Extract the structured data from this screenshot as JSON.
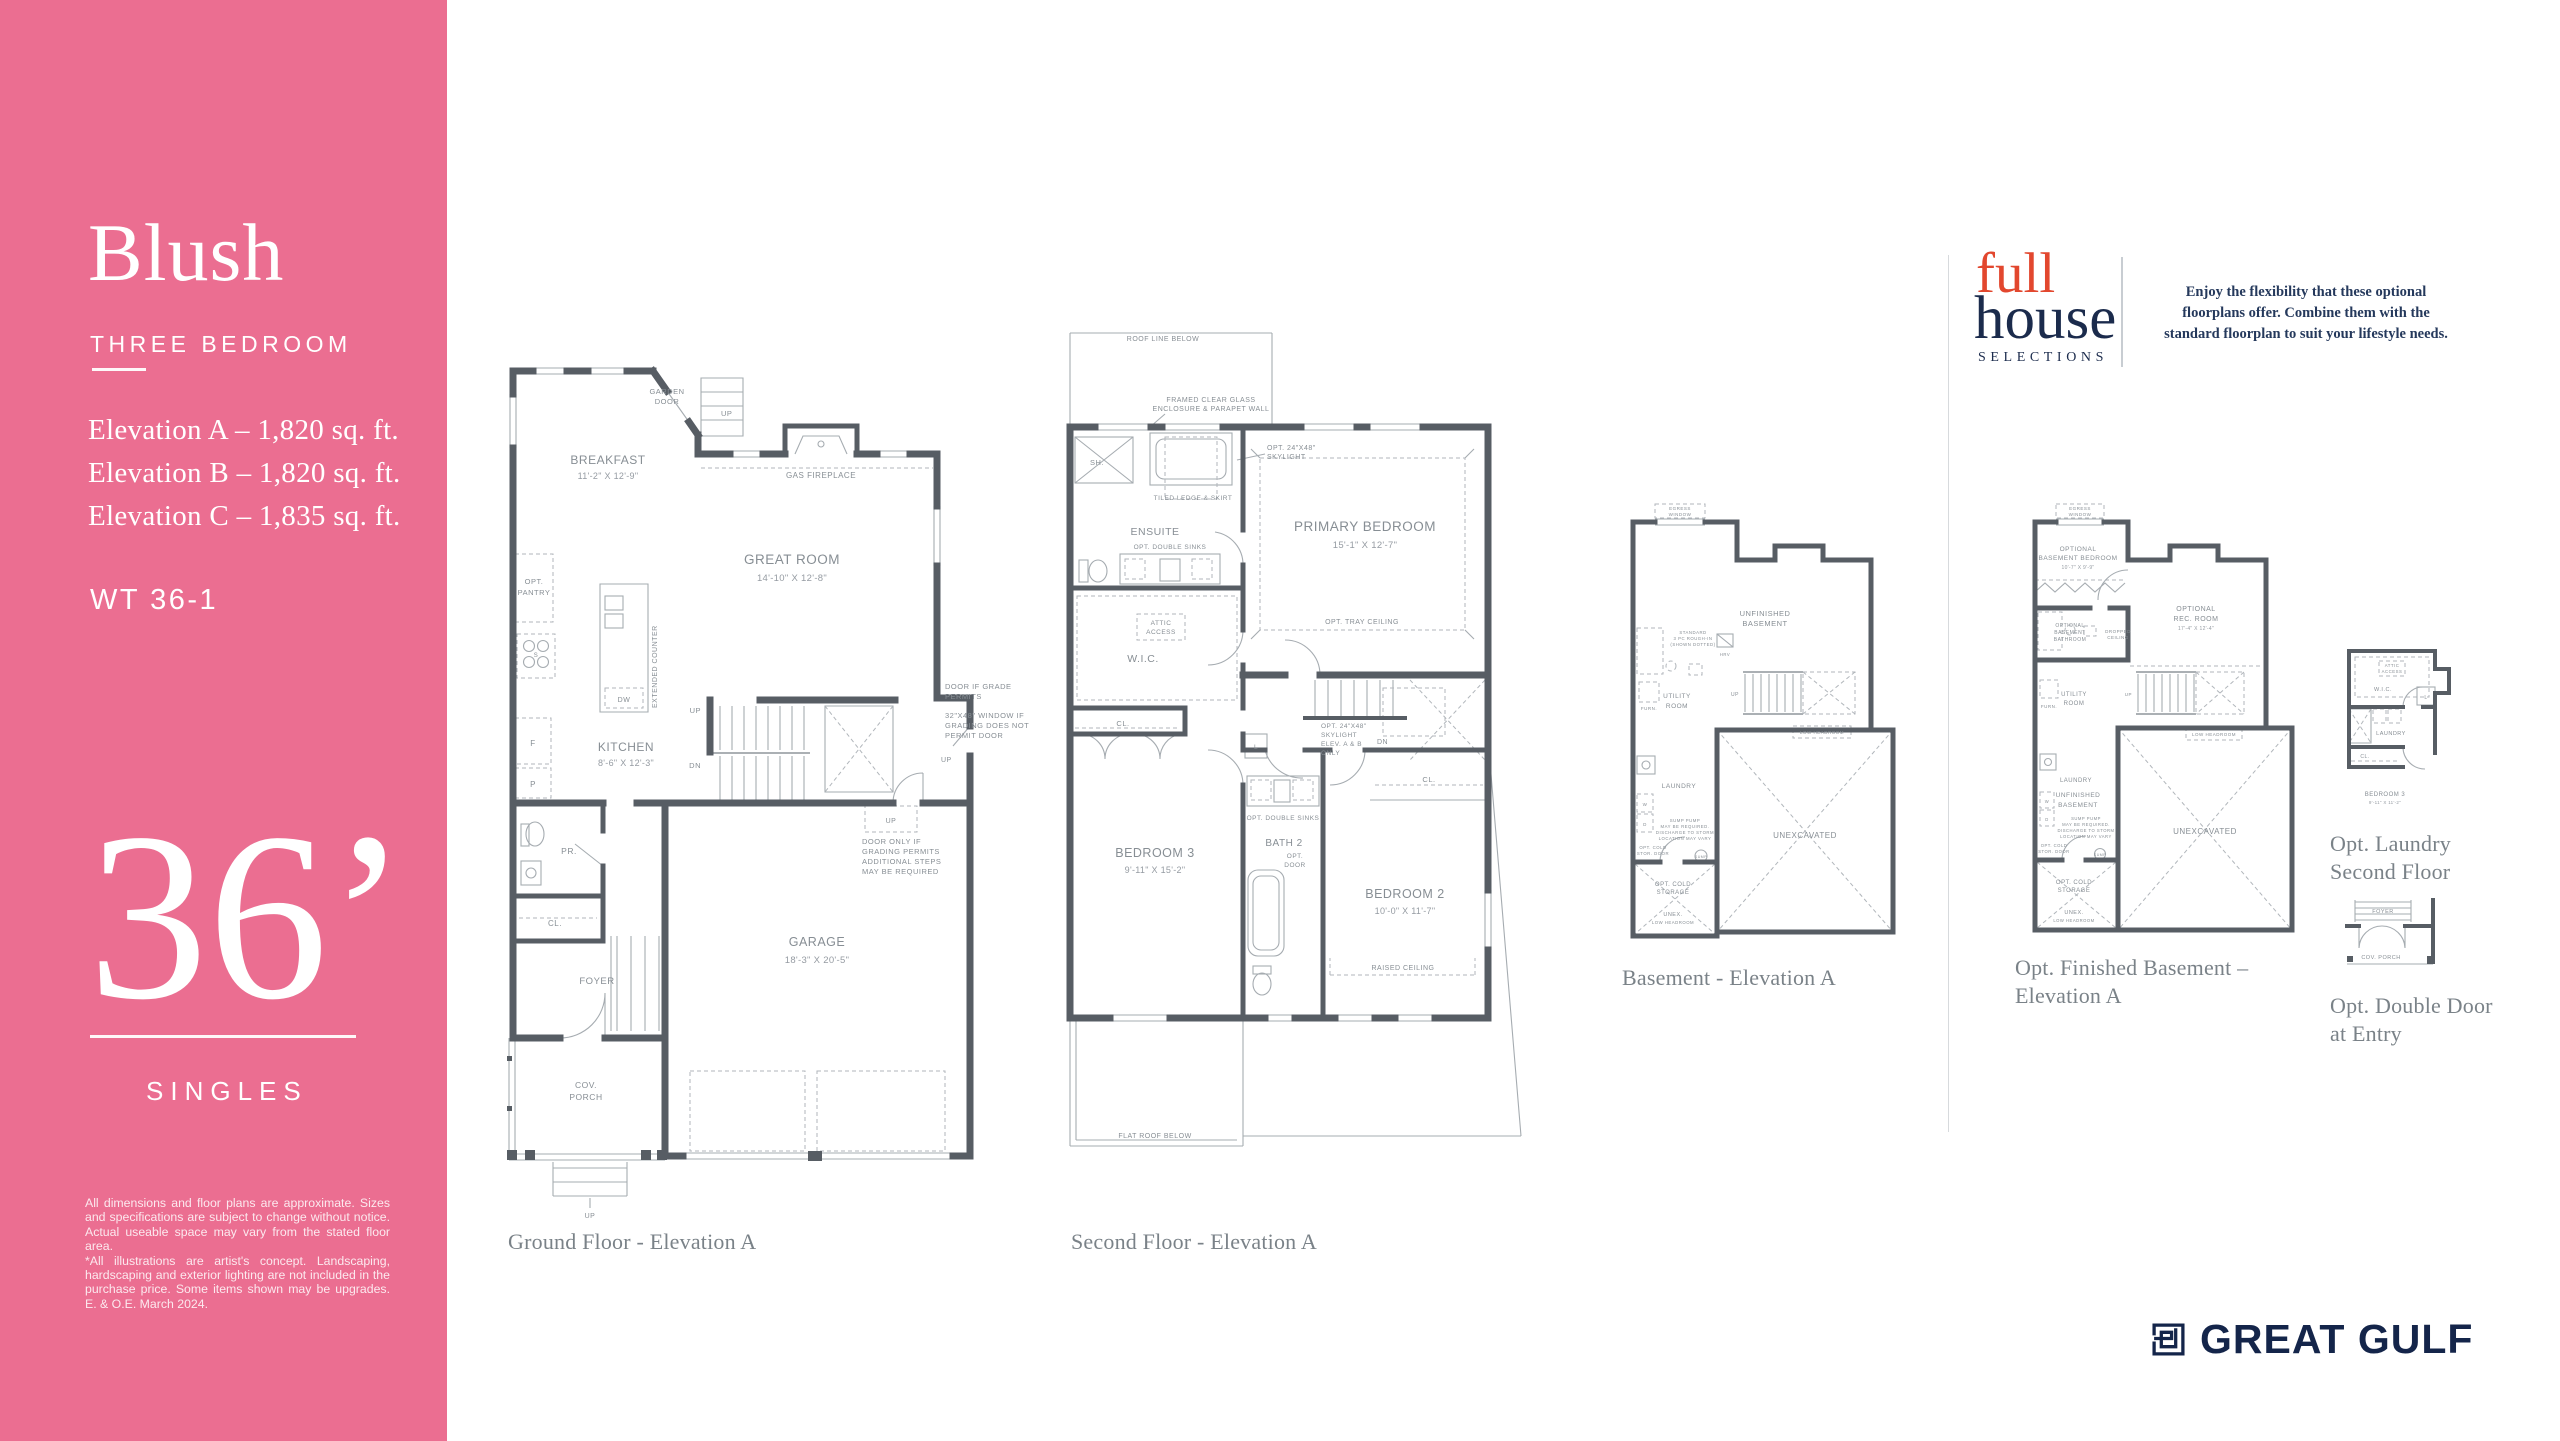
{
  "sidebar": {
    "title": "Blush",
    "subtitle": "THREE BEDROOM",
    "elevations": [
      "Elevation A – 1,820 sq. ft.",
      "Elevation B – 1,820 sq. ft.",
      "Elevation C – 1,835 sq. ft."
    ],
    "model_code": "WT 36-1",
    "lot_width": "36’",
    "category": "SINGLES",
    "disclaimer_1": "All dimensions and floor plans are approximate. Sizes and specifications are subject to change without notice. Actual useable space may vary from the stated floor area.",
    "disclaimer_2": "*All illustrations are artist's concept. Landscaping, hardscaping and exterior lighting are not included in the purchase price. Some items shown may be upgrades. E. & O.E. March 2024."
  },
  "fullhouse": {
    "logo_line1": "full",
    "logo_line2": "house",
    "logo_line3": "SELECTIONS",
    "blurb": [
      "Enjoy the flexibility that these optional",
      "floorplans offer. Combine them with the",
      "standard floorplan to suit your lifestyle needs."
    ]
  },
  "brand": {
    "name": "GREAT GULF"
  },
  "colors": {
    "pink": "#EB6E91",
    "wall": "#575D64",
    "navy": "#1B2B4C",
    "logo_red": "#E2472E",
    "caption_gray": "#7A8288"
  },
  "plans": {
    "ground": {
      "caption": "Ground Floor - Elevation A",
      "labels": {
        "breakfast": "BREAKFAST",
        "breakfast_dim": "11'-2\" X 12'-9\"",
        "great_room": "GREAT ROOM",
        "great_room_dim": "14'-10\" X 12'-8\"",
        "kitchen": "KITCHEN",
        "kitchen_dim": "8'-6\" X 12'-3\"",
        "garage": "GARAGE",
        "garage_dim": "18'-3\" X 20'-5\"",
        "foyer": "FOYER",
        "powder_room": "PR.",
        "closet": "CL.",
        "cov_porch_1": "COV.",
        "cov_porch_2": "PORCH",
        "opt_pantry_1": "OPT.",
        "opt_pantry_2": "PANTRY",
        "garden_door_1": "GARDEN",
        "garden_door_2": "DOOR",
        "gas_fireplace": "GAS FIREPLACE",
        "extended_counter": "EXTENDED COUNTER",
        "dw": "DW",
        "f": "F",
        "p": "P",
        "s": "S",
        "up_deck": "UP",
        "up_stairs": "UP",
        "dn_stairs": "DN",
        "up_side": "UP",
        "up_garage": "UP",
        "up_porch": "UP",
        "note_door_grade": [
          "DOOR IF GRADE",
          "PERMITS"
        ],
        "note_window": [
          "32\"X48\" WINDOW IF",
          "GRADING DOES NOT",
          "PERMIT DOOR"
        ],
        "note_door_only": [
          "DOOR ONLY IF",
          "GRADING PERMITS",
          "ADDITIONAL STEPS",
          "MAY BE REQUIRED"
        ]
      }
    },
    "second": {
      "caption": "Second Floor - Elevation A",
      "labels": {
        "roof_line": "ROOF LINE BELOW",
        "framed_1": "FRAMED CLEAR GLASS",
        "framed_2": "ENCLOSURE & PARAPET WALL",
        "shower": "SH.",
        "skylight_1": "OPT. 24\"X48\"",
        "skylight_2": "SKYLIGHT",
        "tiled_ledge": "TILED LEDGE & SKIRT",
        "ensuite": "ENSUITE",
        "double_sinks": "OPT. DOUBLE SINKS",
        "primary": "PRIMARY BEDROOM",
        "primary_dim": "15'-1\" X 12'-7\"",
        "tray_ceiling": "OPT. TRAY CEILING",
        "attic_1": "ATTIC",
        "attic_2": "ACCESS",
        "wic": "W.I.C.",
        "linen": "L",
        "cl_bed3": "CL.",
        "cl_bed2": "CL.",
        "bed3": "BEDROOM 3",
        "bed3_dim": "9'-11\" X 15'-2\"",
        "bath2": "BATH 2",
        "opt_door_1": "OPT.",
        "opt_door_2": "DOOR",
        "double_sinks2": "OPT. DOUBLE SINKS",
        "skylight2": [
          "OPT. 24\"X48\"",
          "SKYLIGHT",
          "ELEV. A & B",
          "ONLY"
        ],
        "dn": "DN",
        "bed2": "BEDROOM 2",
        "bed2_dim": "10'-0\" X 11'-7\"",
        "raised_ceiling": "RAISED CEILING",
        "flat_roof": "FLAT ROOF BELOW"
      }
    },
    "basement": {
      "caption": "Basement - Elevation A",
      "labels": {
        "egress_1": "EGRESS",
        "egress_2": "WINDOW",
        "unfinished_1": "UNFINISHED",
        "unfinished_2": "BASEMENT",
        "rough_in": [
          "STANDARD",
          "3 PC ROUGH-IN",
          "(SHOWN DOTTED)"
        ],
        "utility_1": "UTILITY",
        "utility_2": "ROOM",
        "laundry": "LAUNDRY",
        "washer": "W",
        "dryer": "D",
        "furnace": "FURN.",
        "hrv": "HRV",
        "up": "UP",
        "low_headroom": "LOW HEADROOM",
        "unexcavated": "UNEXCAVATED",
        "sump_note": [
          "SUMP PUMP",
          "MAY BE REQUIRED.",
          "DISCHARGE TO STORM",
          "LOCATION MAY VARY"
        ],
        "cold_door_1": "OPT. COLD",
        "cold_door_2": "STOR. DOOR",
        "sump": "SUMP",
        "cold_storage_1": "OPT. COLD",
        "cold_storage_2": "STORAGE",
        "unex": "UNEX.",
        "low_headroom2": "LOW HEADROOM"
      }
    },
    "opt_basement": {
      "caption_1": "Opt. Finished Basement –",
      "caption_2": "Elevation A",
      "labels": {
        "egress_1": "EGRESS",
        "egress_2": "WINDOW",
        "bedroom_1": "OPTIONAL",
        "bedroom_2": "BASEMENT BEDROOM",
        "bedroom_dim": "10'-7\" X 9'-9\"",
        "rec_1": "OPTIONAL",
        "rec_2": "REC. ROOM",
        "rec_dim": "17'-4\" X 12'-4\"",
        "bath_1": "OPTIONAL",
        "bath_2": "BASEMENT",
        "bath_3": "BATHROOM",
        "dropped_1": "DROPPED",
        "dropped_2": "CEILING",
        "utility_1": "UTILITY",
        "utility_2": "ROOM",
        "furnace": "FURN.",
        "laundry": "LAUNDRY",
        "washer": "W",
        "dryer": "D",
        "unfinished_1": "UNFINISHED",
        "unfinished_2": "BASEMENT",
        "up": "UP",
        "low_headroom": "LOW HEADROOM",
        "unexcavated": "UNEXCAVATED",
        "sump_note": [
          "SUMP PUMP",
          "MAY BE REQUIRED.",
          "DISCHARGE TO STORM",
          "LOCATION MAY VARY"
        ],
        "cold_door_1": "OPT. COLD",
        "cold_door_2": "STOR. DOOR",
        "sump": "SUMP",
        "cold_storage_1": "OPT. COLD",
        "cold_storage_2": "STORAGE",
        "unex": "UNEX.",
        "low_headroom2": "LOW HEADROOM"
      }
    },
    "opt_laundry": {
      "caption_1": "Opt. Laundry",
      "caption_2": "Second Floor",
      "labels": {
        "attic_1": "ATTIC",
        "attic_2": "ACCESS",
        "wic": "W.I.C.",
        "linen": "L",
        "laundry": "LAUNDRY",
        "cl": "CL.",
        "bed3": "BEDROOM 3",
        "bed3_dim": "9'-11\" X 11'-2\""
      }
    },
    "opt_door": {
      "caption_1": "Opt. Double Door",
      "caption_2": "at Entry",
      "labels": {
        "foyer": "FOYER",
        "cov_porch": "COV. PORCH"
      }
    }
  }
}
